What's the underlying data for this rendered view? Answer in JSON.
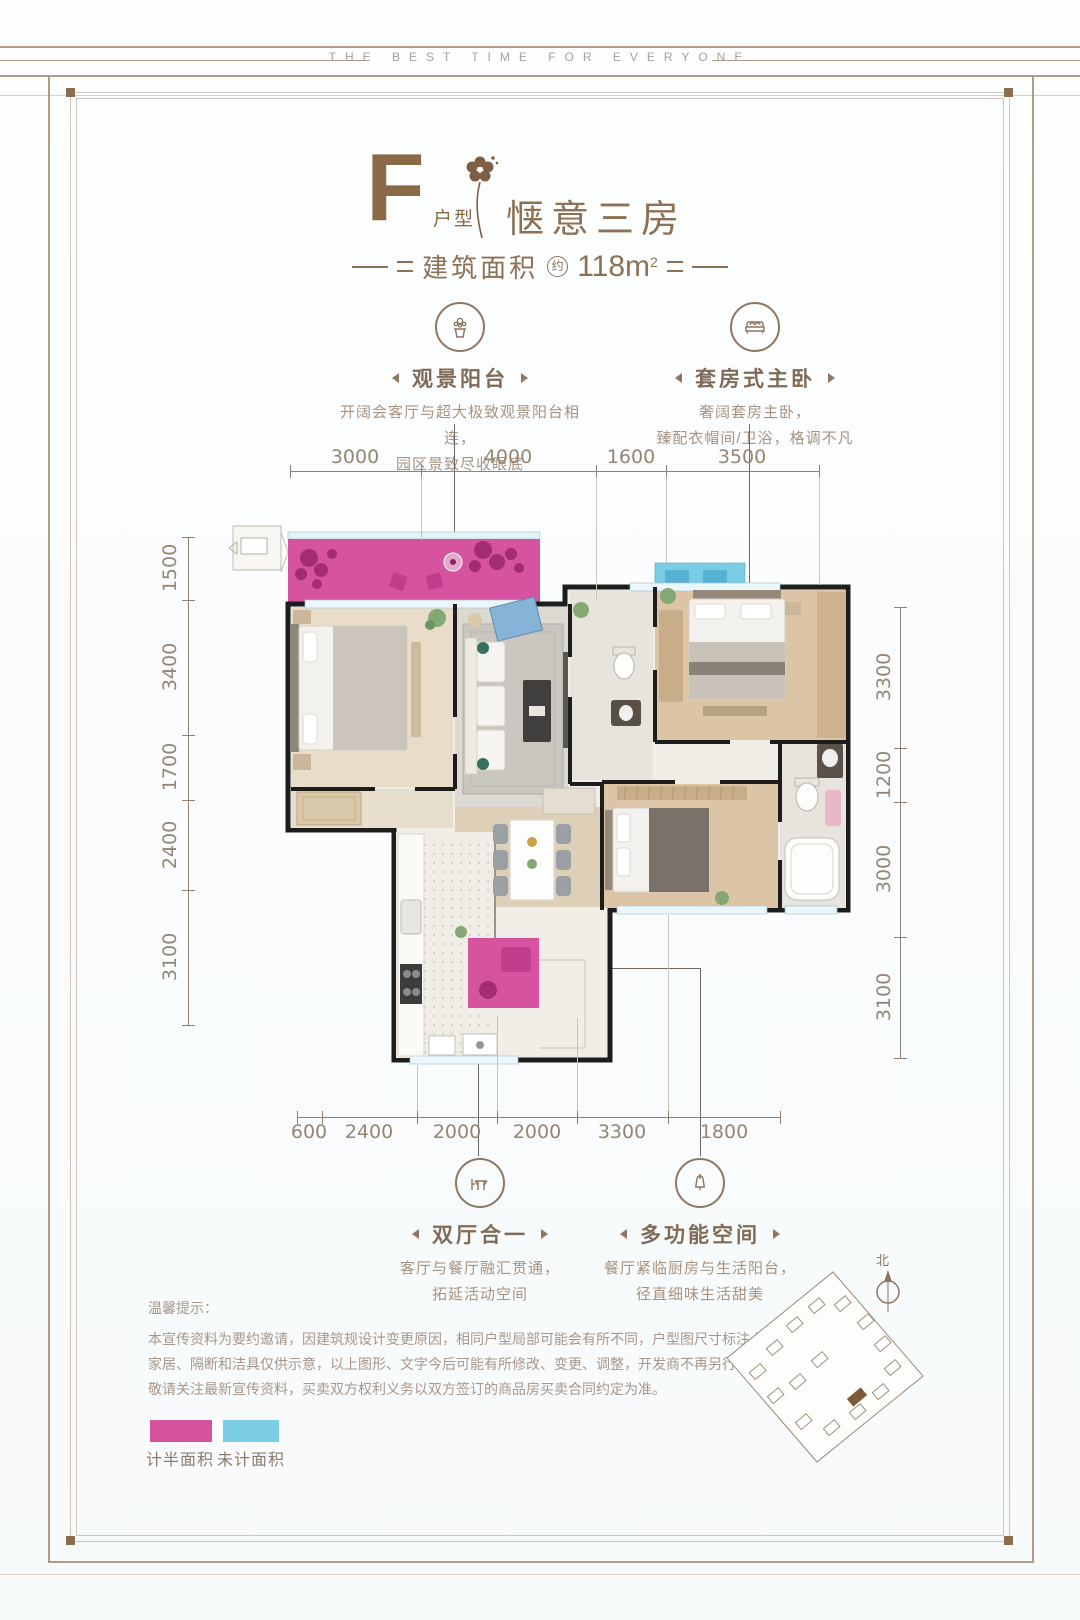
{
  "banner": {
    "text": "THE BEST TIME FOR EVERYONE"
  },
  "title": {
    "letter": "F",
    "letter_label": "户型",
    "name": "惬意三房",
    "area_prefix": "建筑面积",
    "area_approx": "约",
    "area_value": "118m",
    "area_exponent": "2"
  },
  "callouts": {
    "view_balcony": {
      "title": "观景阳台",
      "desc1": "开阔会客厅与超大极致观景阳台相连，",
      "desc2": "园区景致尽收眼底"
    },
    "suite_master": {
      "title": "套房式主卧",
      "desc1": "奢阔套房主卧，",
      "desc2": "臻配衣帽间/卫浴，格调不凡"
    },
    "double_hall": {
      "title": "双厅合一",
      "desc1": "客厅与餐厅融汇贯通，",
      "desc2": "拓延活动空间"
    },
    "multi_space": {
      "title": "多功能空间",
      "desc1": "餐厅紧临厨房与生活阳台，",
      "desc2": "径直细味生活甜美"
    }
  },
  "dimensions": {
    "top": [
      "3000",
      "4000",
      "1600",
      "3500"
    ],
    "left": [
      "1500",
      "3400",
      "1700",
      "2400",
      "3100"
    ],
    "right": [
      "3300",
      "1200",
      "3000",
      "3100"
    ],
    "bottom": [
      "600",
      "2400",
      "2000",
      "2000",
      "3300",
      "1800"
    ]
  },
  "notice": {
    "heading": "温馨提示：",
    "line1": "本宣传资料为要约邀请，因建筑规设计变更原因，相同户型局部可能会有所不同，户型图尺寸标注上可能存在偏差，",
    "line2": "家居、隔断和洁具仅供示意，以上图形、文字今后可能有所修改、变更、调整，开发商不再另行通知，",
    "line3": "敬请关注最新宣传资料，买卖双方权利义务以双方签订的商品房买卖合同约定为准。"
  },
  "legend": {
    "half_area": {
      "label": "计半面积",
      "color": "#d6539f"
    },
    "uncounted_area": {
      "label": "未计面积",
      "color": "#7bcde6"
    }
  },
  "siteplan": {
    "north": "北"
  },
  "colors": {
    "accent_brown": "#8a6a46",
    "text_brown": "#a7937f",
    "dimension_gray": "#958573",
    "half_pink": "#d6539f",
    "uncounted_blue": "#7bcde6",
    "wall_black": "#1d1d1d"
  }
}
